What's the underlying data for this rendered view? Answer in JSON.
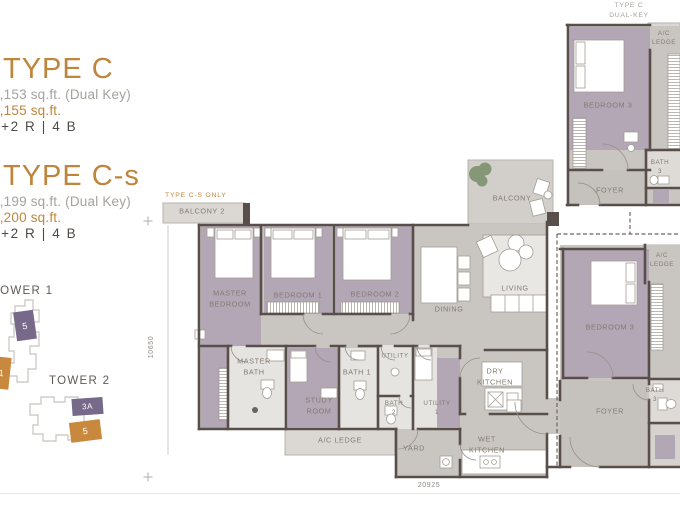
{
  "header": {
    "type_c": {
      "title": "TYPE C",
      "area_dual": "2,153 sq.ft. (Dual Key)",
      "area": "2,155 sq.ft.",
      "config": "4+2 R | 4 B"
    },
    "type_cs": {
      "title": "TYPE C-s",
      "area_dual": "2,199 sq.ft. (Dual Key)",
      "area": "2,200 sq.ft.",
      "config": "4+2 R | 4 B"
    }
  },
  "towers": {
    "tower1": {
      "name": "TOWER 1",
      "unit_purple": "5",
      "unit_orange": "1"
    },
    "tower2": {
      "name": "TOWER 2",
      "unit_purple": "3A",
      "unit_orange": "5"
    }
  },
  "mini_plan": {
    "title": "TYPE C\nDUAL-KEY",
    "labels": {
      "ac_ledge": "A/C\nLEDGE",
      "bedroom3": "BEDROOM 3",
      "bath3": "BATH\n3",
      "foyer": "FOYER"
    }
  },
  "main_plan": {
    "note": "TYPE C-S ONLY",
    "labels": {
      "balcony2": "BALCONY 2",
      "balcony": "BALCONY",
      "master_bedroom": "MASTER\nBEDROOM",
      "bedroom1": "BEDROOM 1",
      "bedroom2": "BEDROOM 2",
      "dining": "DINING",
      "living": "LIVING",
      "master_bath": "MASTER\nBATH",
      "study_room": "STUDY\nROOM",
      "bath1": "BATH 1",
      "utility": "UTILITY",
      "bath2": "BATH\n2",
      "utility1": "UTILITY\n1",
      "dry_kitchen": "DRY\nKITCHEN",
      "wet_kitchen": "WET\nKITCHEN",
      "yard": "YARD",
      "ac_ledge_bottom": "A/C LEDGE",
      "ac_ledge_right": "A/C\nLEDGE",
      "bedroom3": "BEDROOM 3",
      "bath3": "BATH\n3",
      "foyer": "FOYER"
    },
    "dimensions": {
      "height": "10650",
      "width": "20925"
    }
  },
  "colors": {
    "accent_orange": "#c0853c",
    "room_purple": "#b3a6b5",
    "floor_gray": "#c9c6c1",
    "ledge_gray": "#dbd8d4",
    "wall": "#584e4a",
    "tower_unit_purple": "#77698a",
    "tower_unit_orange": "#c8893e",
    "plant_green": "#7e9270"
  }
}
